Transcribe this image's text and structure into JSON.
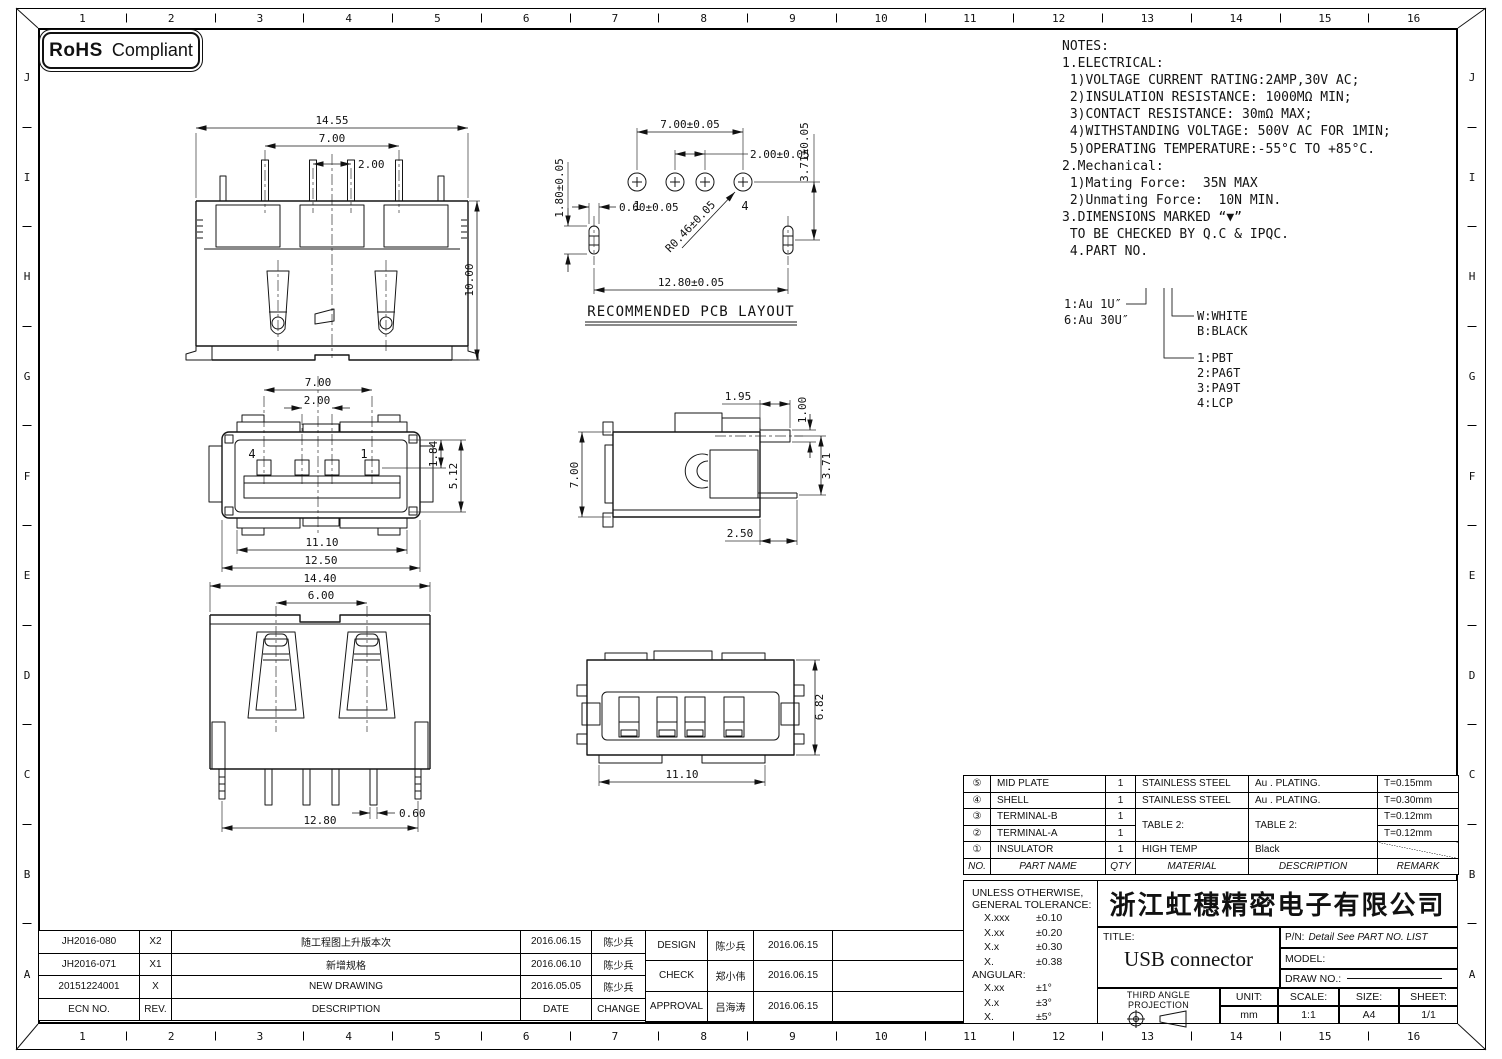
{
  "rohs": {
    "bold": "RoHS",
    "rest": "Compliant"
  },
  "grid": {
    "cols": [
      "1",
      "2",
      "3",
      "4",
      "5",
      "6",
      "7",
      "8",
      "9",
      "10",
      "11",
      "12",
      "13",
      "14",
      "15",
      "16"
    ],
    "rows": [
      "J",
      "I",
      "H",
      "G",
      "F",
      "E",
      "D",
      "C",
      "B",
      "A"
    ]
  },
  "notes": {
    "lines": [
      "NOTES:",
      "1.ELECTRICAL:",
      " 1)VOLTAGE CURRENT RATING:2AMP,30V AC;",
      " 2)INSULATION RESISTANCE: 1000MΩ MIN;",
      " 3)CONTACT RESISTANCE: 30mΩ MAX;",
      " 4)WITHSTANDING VOLTAGE: 500V AC FOR 1MIN;",
      " 5)OPERATING TEMPERATURE:-55°C TO +85°C.",
      "2.Mechanical:",
      " 1)Mating Force:  35N MAX",
      " 2)Unmating Force:  10N MIN.",
      "3.DIMENSIONS MARKED “▼”",
      " TO BE CHECKED BY Q.C & IPQC.",
      " 4.PART NO."
    ]
  },
  "part_tree": {
    "plating_1": "1:Au 1U″",
    "plating_6": "6:Au 30U″",
    "color_w": "W:WHITE",
    "color_b": "B:BLACK",
    "mat_1": "1:PBT",
    "mat_2": "2:PA6T",
    "mat_3": "3:PA9T",
    "mat_4": "4:LCP"
  },
  "views": {
    "front": {
      "dim_width": "14.55",
      "dim_pin_span": "7.00",
      "dim_pitch": "2.00",
      "dim_height": "10.00"
    },
    "pcb": {
      "title": "RECOMMENDED PCB LAYOUT",
      "dim_span": "7.00±0.05",
      "dim_pitch": "2.00±0.05",
      "dim_vert": "3.71±0.05",
      "dim_slot_h": "1.80±0.05",
      "dim_slot_w": "0.60±0.05",
      "dim_radius": "R0.46±0.05",
      "dim_slot_span": "12.80±0.05",
      "pin_first": "1",
      "pin_last": "4"
    },
    "mating": {
      "dim_span": "7.00",
      "dim_pitch": "2.00",
      "dim_contact": "1.84",
      "dim_cavity": "5.12",
      "dim_inner": "11.10",
      "dim_outer": "12.50",
      "pin_left": "4",
      "pin_right": "1"
    },
    "side": {
      "dim_tail": "1.95",
      "dim_thk": "1.00",
      "dim_height": "7.00",
      "dim_pin_drop": "3.71",
      "dim_pin_len": "2.50"
    },
    "rear": {
      "dim_width": "14.40",
      "dim_spring_span": "6.00",
      "dim_leg_w": "0.60",
      "dim_leg_span": "12.80"
    },
    "bottom": {
      "dim_height": "6.82",
      "dim_width": "11.10"
    }
  },
  "bom": {
    "headers": {
      "no": "NO.",
      "part": "PART NAME",
      "qty": "QTY",
      "material": "MATERIAL",
      "description": "DESCRIPTION",
      "remark": "REMARK"
    },
    "rows": [
      {
        "no": "⑤",
        "part": "MID PLATE",
        "qty": "1",
        "material": "STAINLESS STEEL",
        "description": "Au . PLATING.",
        "remark": "T=0.15mm"
      },
      {
        "no": "④",
        "part": "SHELL",
        "qty": "1",
        "material": "STAINLESS STEEL",
        "description": "Au . PLATING.",
        "remark": "T=0.30mm"
      },
      {
        "no": "③",
        "part": "TERMINAL-B",
        "qty": "1",
        "material": "TABLE 2:",
        "description": "TABLE 2:",
        "remark": "T=0.12mm"
      },
      {
        "no": "②",
        "part": "TERMINAL-A",
        "qty": "1",
        "remark": "T=0.12mm"
      },
      {
        "no": "①",
        "part": "INSULATOR",
        "qty": "1",
        "material": "HIGH TEMP",
        "description": "Black",
        "remark": ""
      }
    ]
  },
  "tolerance": {
    "title1": "UNLESS OTHERWISE,",
    "title2": "GENERAL TOLERANCE:",
    "linear": [
      [
        "X.xxx",
        "±0.10"
      ],
      [
        "X.xx",
        "±0.20"
      ],
      [
        "X.x",
        "±0.30"
      ],
      [
        "X.",
        "±0.38"
      ]
    ],
    "angular_label": "ANGULAR:",
    "angular": [
      [
        "X.xx",
        "±1°"
      ],
      [
        "X.x",
        "±3°"
      ],
      [
        "X.",
        "±5°"
      ]
    ]
  },
  "title_block": {
    "company": "浙江虹穗精密电子有限公司",
    "title_label": "TITLE:",
    "title": "USB connector",
    "pn_label": "P/N:",
    "pn_value": "Detail See PART NO. LIST",
    "model_label": "MODEL:",
    "draw_label": "DRAW NO.:",
    "projection_label": "THIRD ANGLE PROJECTION",
    "unit_label": "UNIT:",
    "unit": "mm",
    "scale_label": "SCALE:",
    "scale": "1:1",
    "size_label": "SIZE:",
    "size": "A4",
    "sheet_label": "SHEET:",
    "sheet": "1/1"
  },
  "revisions": {
    "headers": {
      "ecn": "ECN NO.",
      "rev": "REV.",
      "description": "DESCRIPTION",
      "date": "DATE",
      "change": "CHANGE"
    },
    "rows": [
      {
        "ecn": "JH2016-080",
        "rev": "X2",
        "description": "随工程图上升版本次",
        "date": "2016.06.15",
        "change": "陈少兵"
      },
      {
        "ecn": "JH2016-071",
        "rev": "X1",
        "description": "新增规格",
        "date": "2016.06.10",
        "change": "陈少兵"
      },
      {
        "ecn": "20151224001",
        "rev": "X",
        "description": "NEW DRAWING",
        "date": "2016.05.05",
        "change": "陈少兵"
      }
    ]
  },
  "approvals": {
    "rows": [
      {
        "role": "DESIGN",
        "name": "陈少兵",
        "date": "2016.06.15"
      },
      {
        "role": "CHECK",
        "name": "郑小伟",
        "date": "2016.06.15"
      },
      {
        "role": "APPROVAL",
        "name": "吕海涛",
        "date": "2016.06.15"
      }
    ]
  }
}
